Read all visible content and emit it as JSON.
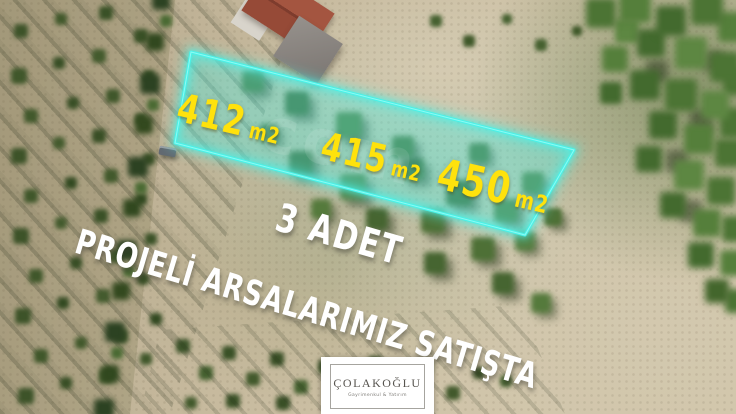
{
  "overlay": {
    "parcels": [
      {
        "area": "412",
        "unit": "m2"
      },
      {
        "area": "415",
        "unit": "m2"
      },
      {
        "area": "450",
        "unit": "m2"
      }
    ],
    "slogan_line1": "3 ADET",
    "slogan_line2": "PROJELİ ARSALARIMIZ SATIŞTA",
    "watermark": "com",
    "highlight_color": "#49F2E8",
    "label_color": "#FFE20C",
    "slogan_color": "#FFFFFF"
  },
  "logo": {
    "title": "ÇOLAKOĞLU",
    "subtitle": "Gayrimenkul & Yatırım"
  }
}
